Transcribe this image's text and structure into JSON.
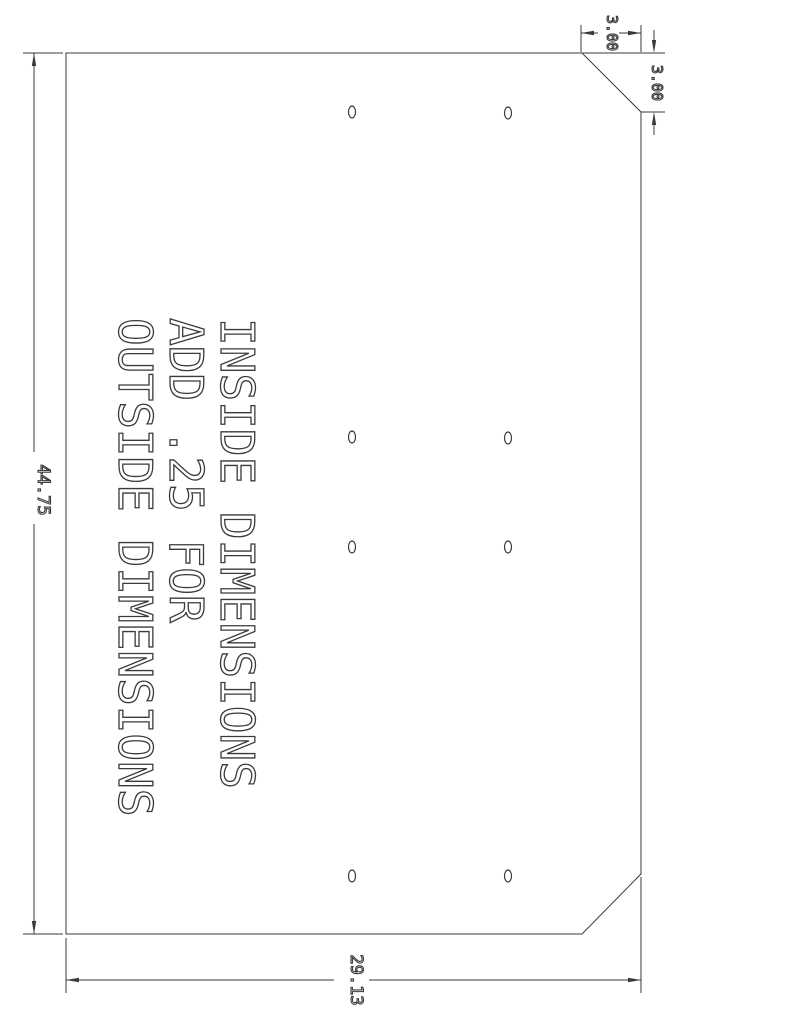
{
  "note": {
    "lines": [
      "INSIDE DIMENSIONS",
      "ADD .25 FOR",
      "OUTSIDE DIMENSIONS"
    ]
  },
  "dimensions": {
    "overall_height": "44.75",
    "overall_width": "29.13",
    "chamfer_width": "3.00",
    "chamfer_height": "3.00"
  },
  "holes": [
    {
      "x": 352,
      "y": 112
    },
    {
      "x": 508,
      "y": 113
    },
    {
      "x": 352,
      "y": 437
    },
    {
      "x": 508,
      "y": 438
    },
    {
      "x": 352,
      "y": 547
    },
    {
      "x": 508,
      "y": 547
    },
    {
      "x": 352,
      "y": 876
    },
    {
      "x": 508,
      "y": 876
    }
  ],
  "colors": {
    "line": "#3a3a3a",
    "background": "#ffffff"
  }
}
